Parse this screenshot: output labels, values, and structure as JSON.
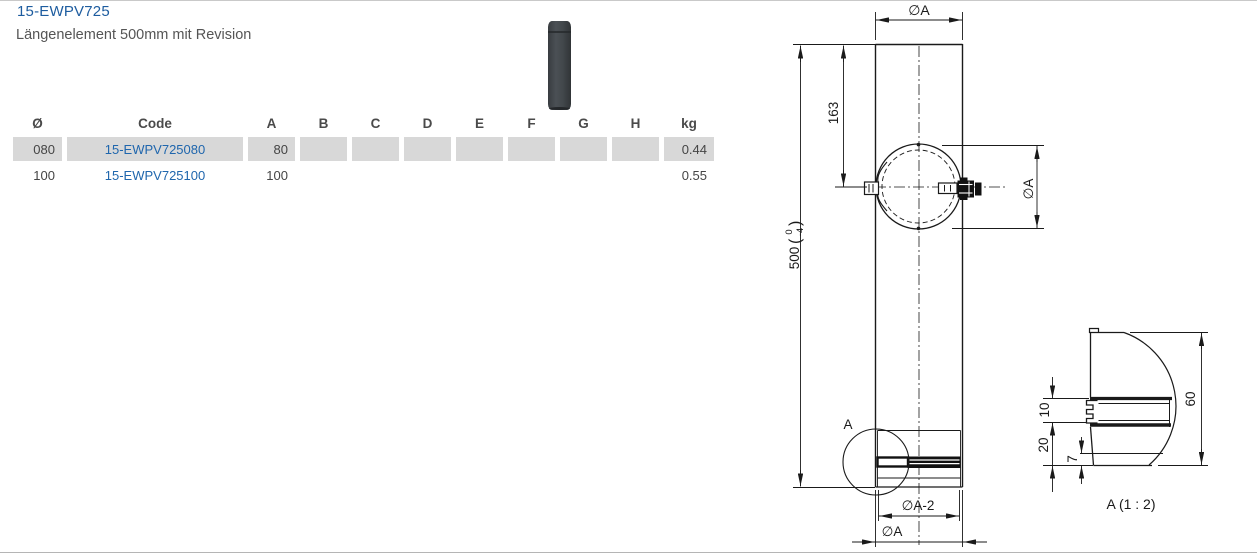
{
  "page": {
    "title": "15-EWPV725",
    "subtitle": "Längenelement 500mm mit Revision"
  },
  "table": {
    "headers": [
      "Ø",
      "Code",
      "A",
      "B",
      "C",
      "D",
      "E",
      "F",
      "G",
      "H",
      "kg"
    ],
    "rows": [
      {
        "cells": [
          "080",
          "15-EWPV725080",
          "80",
          "",
          "",
          "",
          "",
          "",
          "",
          "",
          "0.44"
        ]
      },
      {
        "cells": [
          "100",
          "15-EWPV725100",
          "100",
          "",
          "",
          "",
          "",
          "",
          "",
          "",
          "0.55"
        ]
      }
    ]
  },
  "drawing": {
    "dim_dia_top": "∅A",
    "dim_163": "163",
    "dim_500_value": "500",
    "tol_open": "(",
    "tol_upper": "0",
    "tol_lower": "-4",
    "tol_close": ")",
    "dim_dia_right": "∅A",
    "detail_marker": "A",
    "dim_dia_minus2": "∅A-2",
    "dim_dia_bottom": "∅A",
    "detail": {
      "label": "A (1 : 2)",
      "dim_60": "60",
      "dim_10": "10",
      "dim_20": "20",
      "dim_7": "7"
    }
  },
  "colors": {
    "title_blue": "#1d5c9f",
    "link_blue": "#1f66ad",
    "row_gray": "#d8d8d8",
    "text_gray": "#454545",
    "line_black": "#1a1a1a",
    "thumb_dark": "#3e4347"
  }
}
